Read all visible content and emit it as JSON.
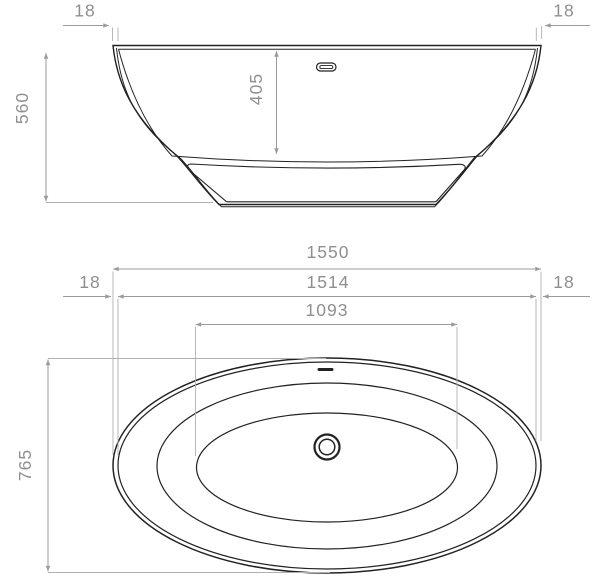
{
  "drawing": {
    "subject": "freestanding-bathtub-dimension-drawing",
    "views": [
      "side-elevation",
      "plan-view"
    ],
    "units_implied": "mm"
  },
  "colors": {
    "background": "#ffffff",
    "outline": "#222222",
    "dimension_line": "#9b9b9b",
    "dimension_text": "#8f8f8f"
  },
  "dims": {
    "side_rim_left": "18",
    "side_rim_right": "18",
    "height": "560",
    "depth": "405",
    "overall_length": "1550",
    "internal_length": "1514",
    "basin_length": "1093",
    "plan_rim_left": "18",
    "plan_rim_right": "18",
    "overall_width": "765"
  }
}
